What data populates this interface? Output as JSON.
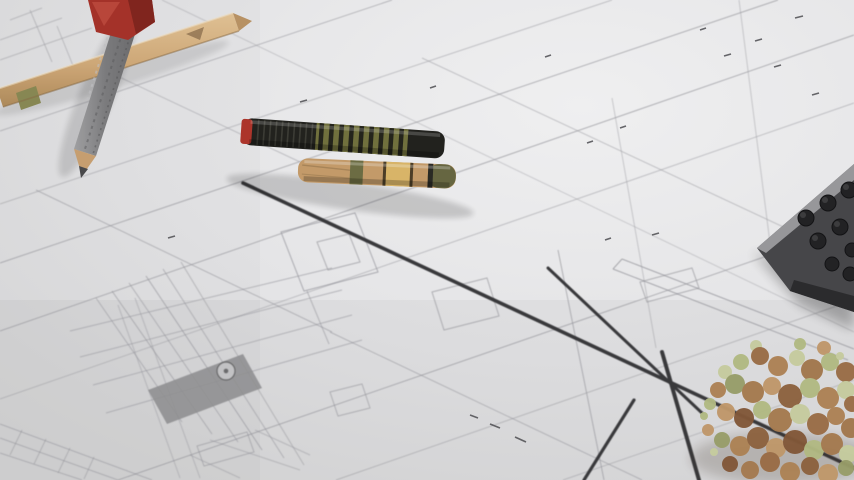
{
  "scene": {
    "type": "photograph",
    "alt": "Close-up photo of architectural blueprint drawings lying on a desk, shot at a shallow angle. Drafting tools rest on the plans: pencils, a vintage striped pen, the corner of a calculator and a scale-model tree.",
    "description": "Architectural plans with drafting tools"
  },
  "objects": {
    "blueprint_sheet": {
      "label": "architectural blueprint sheet with floor-plan wall lines, door details and an elevation detail drawing"
    },
    "wall_lines": {
      "label": "thick dark plan wall lines crossing the sheet diagonally"
    },
    "detail_drawing": {
      "label": "dense elevation / section detail drawing with hatched grey bar and circle marker"
    },
    "annotations": {
      "label": "tiny illegible dimension annotations scattered on the sheet"
    },
    "tan_pencil": {
      "label": "tan wooden pencil lying across the top-left corner",
      "color": "#d2ab7a"
    },
    "grey_pencil": {
      "label": "grey knurled pencil with sharpened wood-and-graphite tip",
      "color": "#8b8b8e"
    },
    "red_sharpener": {
      "label": "red sharpener / tool handle at the top edge",
      "color": "#a8342a"
    },
    "vintage_pen": {
      "label": "vintage pen with red band, black grip, olive-black striped barrel and brass lower barrel",
      "colors": [
        "#b0372c",
        "#23231f",
        "#73733f",
        "#c79e6c",
        "#ddb86b"
      ]
    },
    "calculator": {
      "label": "corner of a dark calculator with round black keys",
      "color": "#48484b"
    },
    "model_tree": {
      "label": "architectural model tree in tan and pale green foliage",
      "colors": [
        "#b08456",
        "#8f6340",
        "#b5bd85",
        "#c9cfa2"
      ]
    }
  },
  "palette": {
    "paper": "#e7e7e9",
    "paper-hi": "#f4f4f5",
    "line": "#9b9ba1",
    "wall": "#3b3b3e",
    "ink": "#4f4f54",
    "wood": "#caa273",
    "red": "#b0372c",
    "olive": "#73733f",
    "brass": "#ddb86b",
    "calc": "#48484b",
    "tree-brown": "#b08456",
    "tree-green": "#b5bd85"
  }
}
